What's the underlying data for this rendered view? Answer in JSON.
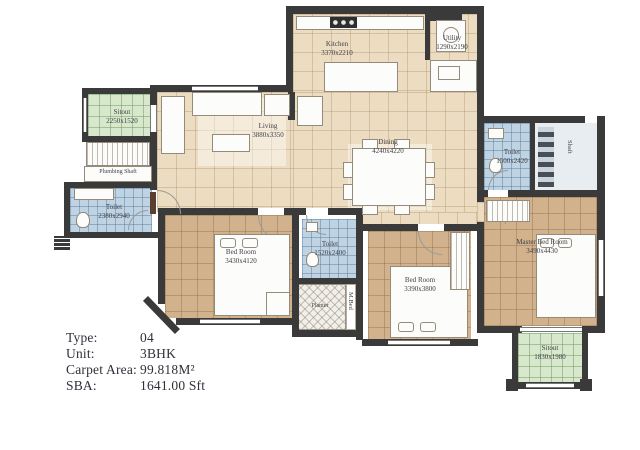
{
  "info": {
    "rows": [
      {
        "label": "Type:",
        "value": "04"
      },
      {
        "label": "Unit:",
        "value": "3BHK"
      },
      {
        "label": "Carpet Area:",
        "value": "99.818M²"
      },
      {
        "label": "SBA:",
        "value": "1641.00 Sft"
      }
    ]
  },
  "rooms": {
    "kitchen": {
      "name": "Kitchen",
      "dims": "3370x2210"
    },
    "utility": {
      "name": "Utility",
      "dims": "1290x2190"
    },
    "living": {
      "name": "Living",
      "dims": "3880x3350"
    },
    "dining": {
      "name": "Dining",
      "dims": "4240x4220"
    },
    "sitout_left": {
      "name": "Sitout",
      "dims": "2250x1520"
    },
    "plumbing_shaft": {
      "name": "Plumbing Shaft",
      "dims": ""
    },
    "toilet_left": {
      "name": "Toilet",
      "dims": "2380x2940"
    },
    "bedroom_left": {
      "name": "Bed Room",
      "dims": "3430x4120"
    },
    "toilet_middle": {
      "name": "Toilet",
      "dims": "1520x2400"
    },
    "planter": {
      "name": "Planter",
      "dims": ""
    },
    "mbed": {
      "name": "M.Bed",
      "dims": ""
    },
    "bedroom_middle": {
      "name": "Bed Room",
      "dims": "3390x3800"
    },
    "toilet_right": {
      "name": "Toilet",
      "dims": "1500x2420"
    },
    "shaft": {
      "name": "Shaft",
      "dims": ""
    },
    "master_bedroom": {
      "name": "Master Bed Room",
      "dims": "3490x4430"
    },
    "sitout_right": {
      "name": "Sitout",
      "dims": "1830x1980"
    }
  },
  "colors": {
    "wall": "#3a3a3a",
    "floor_common": "#ecdcc1",
    "floor_bedroom": "#d1b28c",
    "floor_toilet": "#bfd3e3",
    "floor_sitout": "#d8e8cd"
  }
}
